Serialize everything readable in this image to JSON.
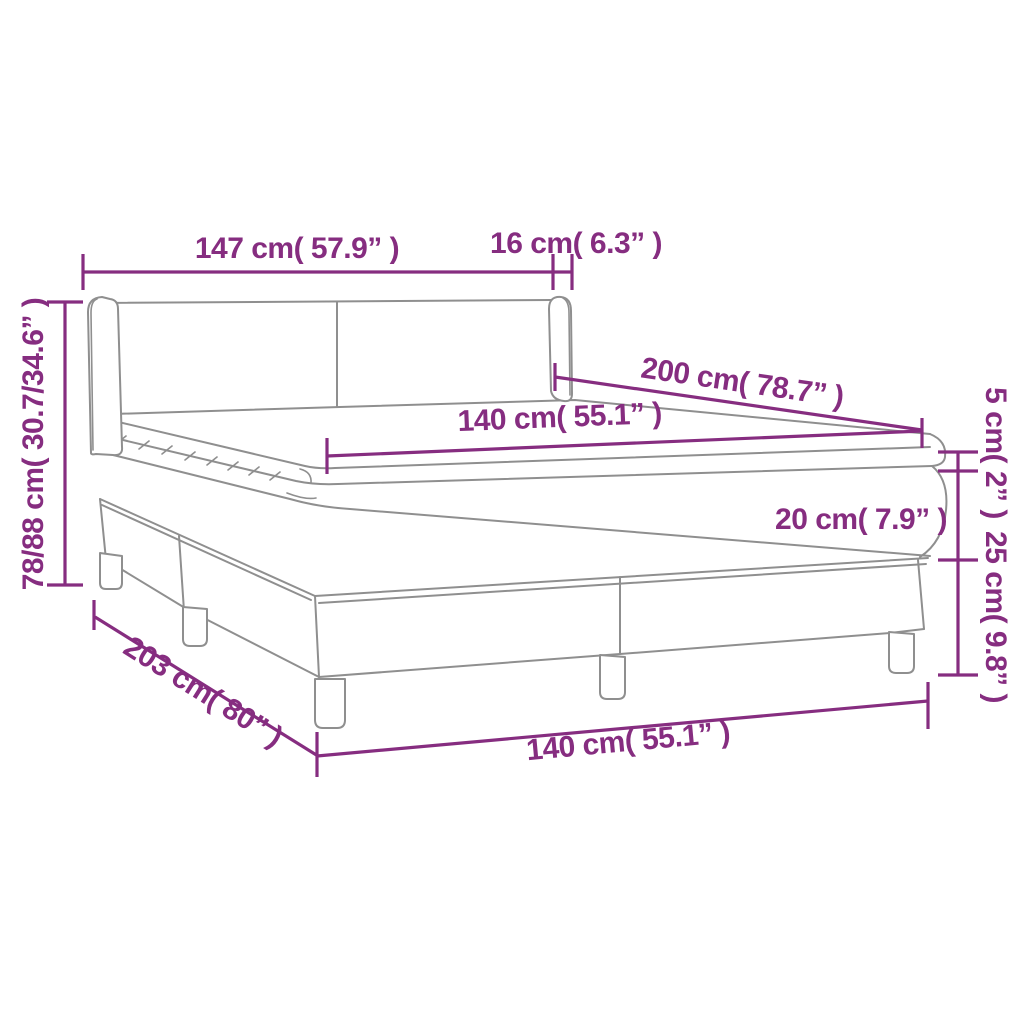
{
  "diagram": {
    "title": "Box spring bed with topper dimension diagram",
    "product": "box-spring-bed-with-headboard-topper-and-legs",
    "background_color": "#FFFFFF",
    "dimension_color": "#862D80",
    "artwork_line_color": "#8F8F8F",
    "labels": {
      "headboard_width": "147 cm( 57.9” )",
      "headboard_side_depth": "16 cm( 6.3” )",
      "headboard_height": "78/88 cm( 30.7/34.6” )",
      "bed_length_top": "200 cm( 78.7” )",
      "mattress_width_top": "140 cm( 55.1” )",
      "topper_height": "5 cm( 2” )",
      "mattress_height": "20 cm( 7.9” )",
      "base_height": "25 cm( 9.8” )",
      "bed_length_bottom": "203 cm( 80” )",
      "bed_width_bottom": "140 cm( 55.1” )"
    },
    "measurements": [
      {
        "part": "headboard width",
        "cm": "147",
        "inch": "57.9"
      },
      {
        "part": "headboard side depth",
        "cm": "16",
        "inch": "6.3"
      },
      {
        "part": "headboard height",
        "cm": "78/88",
        "inch": "30.7/34.6"
      },
      {
        "part": "mattress length",
        "cm": "200",
        "inch": "78.7"
      },
      {
        "part": "mattress width",
        "cm": "140",
        "inch": "55.1"
      },
      {
        "part": "topper height",
        "cm": "5",
        "inch": "2"
      },
      {
        "part": "mattress height",
        "cm": "20",
        "inch": "7.9"
      },
      {
        "part": "base height",
        "cm": "25",
        "inch": "9.8"
      },
      {
        "part": "bed length",
        "cm": "203",
        "inch": "80"
      },
      {
        "part": "bed width",
        "cm": "140",
        "inch": "55.1"
      }
    ]
  }
}
